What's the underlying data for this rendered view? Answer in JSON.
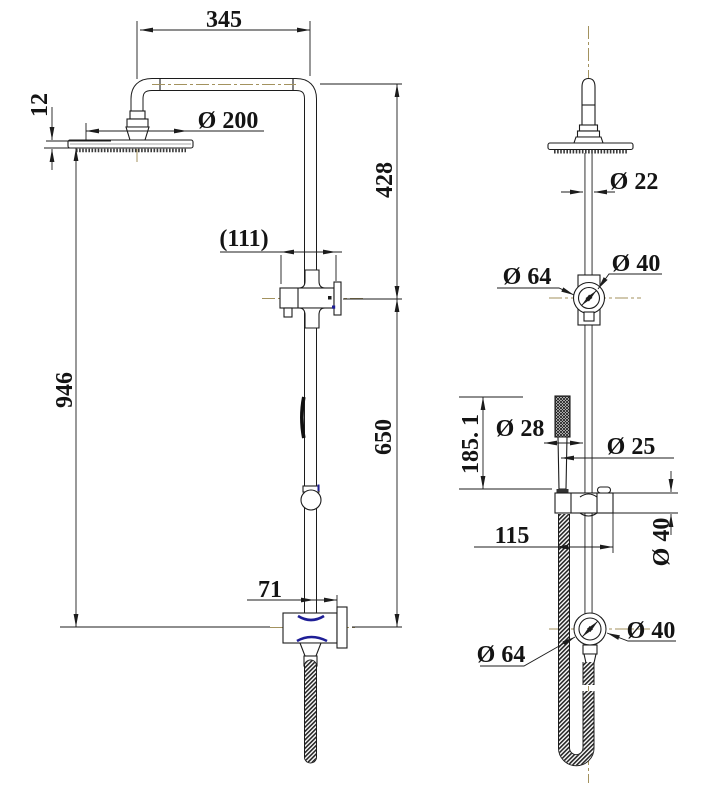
{
  "drawing": {
    "colors": {
      "line": "#1c1c1c",
      "centerline": "#a3925e",
      "detail_blue": "#1e1e96"
    },
    "views": {
      "front": {
        "dims": {
          "arm_reach": "345",
          "head_thickness": "12",
          "head_diameter": "Ø 200",
          "diverter_width": "(111)",
          "upper_drop": "428",
          "overall_height": "946",
          "lower_drop": "650",
          "wall_offset": "71"
        }
      },
      "side": {
        "dims": {
          "pipe_diameter": "Ø 22",
          "diverter_outer_diameter": "Ø 64",
          "diverter_inner_diameter": "Ø 40",
          "handshower_diameter": "Ø 28",
          "rail_diameter": "Ø 25",
          "handshower_length": "185. 1",
          "bracket_length": "115",
          "bracket_diameter": "Ø 40",
          "elbow_outer_diameter": "Ø 64",
          "elbow_inner_diameter": "Ø 40"
        }
      }
    }
  }
}
